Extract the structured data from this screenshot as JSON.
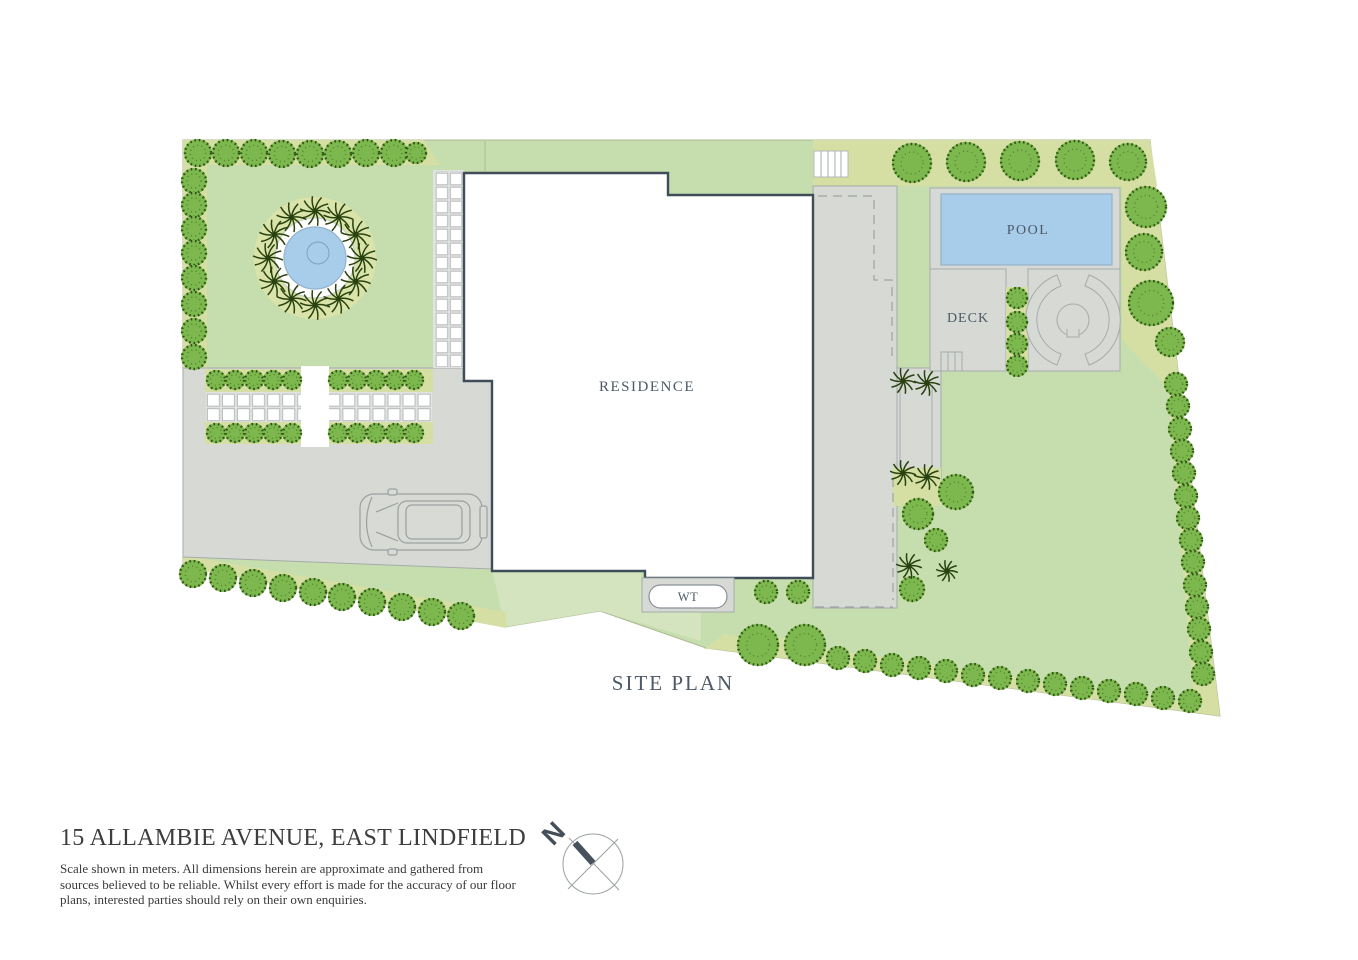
{
  "plan": {
    "labels": {
      "residence": "RESIDENCE",
      "pool": "POOL",
      "deck": "DECK",
      "water_tank": "WT",
      "caption": "SITE PLAN",
      "compass_north": "N"
    },
    "colors": {
      "lawn": "#c6deae",
      "lawn_light": "#d3e4bf",
      "olive": "#d5dfa3",
      "paving": "#d7d9d5",
      "line": "#a5abab",
      "outline": "#3e4d57",
      "pool_water": "#a8cdeb",
      "tree": "#7db84e",
      "tree_dark": "#2f5214",
      "palm": "#28420f",
      "label_text": "#4d5966"
    }
  },
  "footer": {
    "title": "15 ALLAMBIE AVENUE, EAST LINDFIELD",
    "disclaimer_lines": [
      "Scale shown in meters. All dimensions herein are approximate and gathered from",
      "sources believed to be reliable. Whilst every effort is made for the accuracy of our floor",
      "plans, interested parties should rely on their own enquiries."
    ]
  }
}
